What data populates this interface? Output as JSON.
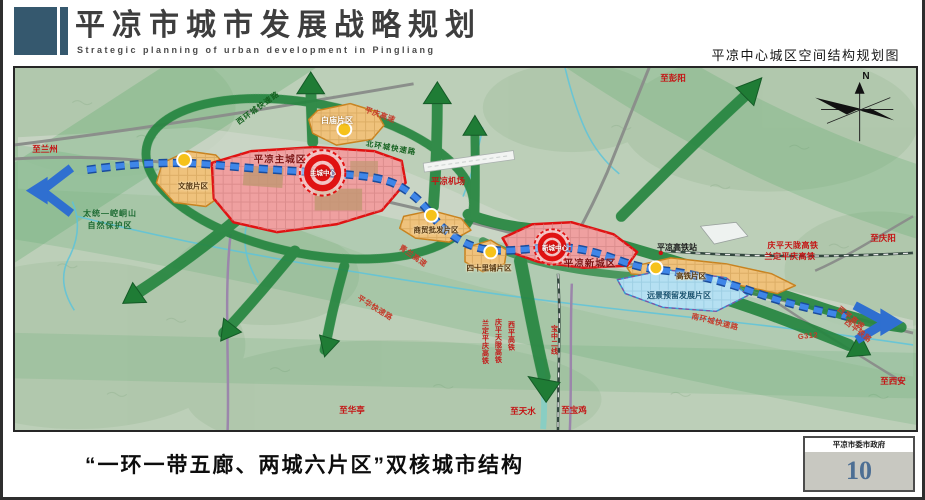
{
  "header": {
    "title": "平凉市城市发展战略规划",
    "subtitle": "Strategic planning of urban development in Pingliang",
    "map_title": "平凉中心城区空间结构规划图"
  },
  "footer": {
    "caption": "“一环一带五廊、两城六片区”双核城市结构",
    "agency": "平凉市委市政府",
    "page": "10"
  },
  "colors": {
    "header_block": "#35586e",
    "corridor_green": "#268540",
    "axis_blue": "#3f86e8",
    "core_red": "#e01212",
    "zone_orange": "#efc27c",
    "zone_pink": "#efa0a0",
    "zone_blue": "#b5e0f2",
    "page_number_blue": "#4d6f94"
  },
  "map": {
    "labels": [
      {
        "text": "至兰州",
        "x": 30,
        "y": 81,
        "cls": "dest"
      },
      {
        "text": "至彭阳",
        "x": 658,
        "y": 10,
        "cls": "dest"
      },
      {
        "text": "至庆阳",
        "x": 868,
        "y": 170,
        "cls": "dest"
      },
      {
        "text": "至西安",
        "x": 878,
        "y": 313,
        "cls": "dest"
      },
      {
        "text": "至华亭",
        "x": 337,
        "y": 342,
        "cls": "dest"
      },
      {
        "text": "至天水",
        "x": 508,
        "y": 343,
        "cls": "dest"
      },
      {
        "text": "至宝鸡",
        "x": 559,
        "y": 342,
        "cls": "dest"
      },
      {
        "text": "平凉机场",
        "x": 433,
        "y": 113,
        "cls": "dest"
      },
      {
        "text": "庆平天陇高铁",
        "x": 778,
        "y": 178,
        "cls": "rail"
      },
      {
        "text": "兰定平庆高铁",
        "x": 775,
        "y": 189,
        "cls": "rail"
      },
      {
        "text": "平庆高速",
        "x": 365,
        "y": 47,
        "cls": "road-red",
        "rot": 20
      },
      {
        "text": "青兰高速",
        "x": 398,
        "y": 188,
        "cls": "road-red",
        "rot": 35
      },
      {
        "text": "平华快速路",
        "x": 360,
        "y": 240,
        "cls": "road-red",
        "rot": 32
      },
      {
        "text": "南环城快速路",
        "x": 700,
        "y": 254,
        "cls": "road-red",
        "rot": 14
      },
      {
        "text": "G312",
        "x": 793,
        "y": 268,
        "cls": "road-red",
        "rot": -6
      },
      {
        "text": "西平高速",
        "x": 836,
        "y": 250,
        "cls": "road-red",
        "rot": 38
      },
      {
        "text": "西平铁路",
        "x": 843,
        "y": 263,
        "cls": "road-red",
        "rot": 38
      },
      {
        "text": "西环城快速路",
        "x": 243,
        "y": 40,
        "cls": "road-green",
        "rot": -36
      },
      {
        "text": "北环城快速路",
        "x": 376,
        "y": 80,
        "cls": "road-green",
        "rot": 10
      },
      {
        "text": "太统—崆峒山",
        "x": 95,
        "y": 146,
        "cls": "nature"
      },
      {
        "text": "自然保护区",
        "x": 95,
        "y": 158,
        "cls": "nature"
      },
      {
        "text": "白庙片区",
        "x": 322,
        "y": 53,
        "cls": "zone-light"
      },
      {
        "text": "文旅片区",
        "x": 178,
        "y": 118,
        "cls": "zone"
      },
      {
        "text": "平凉主城区",
        "x": 265,
        "y": 92,
        "cls": "city"
      },
      {
        "text": "主城中心",
        "x": 308,
        "y": 106,
        "cls": "core"
      },
      {
        "text": "商贸批发片区",
        "x": 421,
        "y": 162,
        "cls": "zone"
      },
      {
        "text": "四十里铺片区",
        "x": 474,
        "y": 200,
        "cls": "zone"
      },
      {
        "text": "平凉新城区",
        "x": 575,
        "y": 196,
        "cls": "city"
      },
      {
        "text": "新城中心",
        "x": 540,
        "y": 181,
        "cls": "core"
      },
      {
        "text": "高铁片区",
        "x": 676,
        "y": 208,
        "cls": "zone"
      },
      {
        "text": "远景预留发展片区",
        "x": 664,
        "y": 228,
        "cls": "zone-blue"
      },
      {
        "text": "平凉高铁站",
        "x": 662,
        "y": 180,
        "cls": "station"
      },
      {
        "text": "兰定平庆高铁",
        "x": 470,
        "y": 274,
        "cls": "rail-v"
      },
      {
        "text": "庆平天陇高铁",
        "x": 483,
        "y": 273,
        "cls": "rail-v"
      },
      {
        "text": "西平高铁",
        "x": 496,
        "y": 268,
        "cls": "rail-v"
      },
      {
        "text": "宝中二线",
        "x": 539,
        "y": 272,
        "cls": "rail-v"
      },
      {
        "text": "N",
        "x": 851,
        "y": 9,
        "cls": "compass-n"
      }
    ]
  }
}
